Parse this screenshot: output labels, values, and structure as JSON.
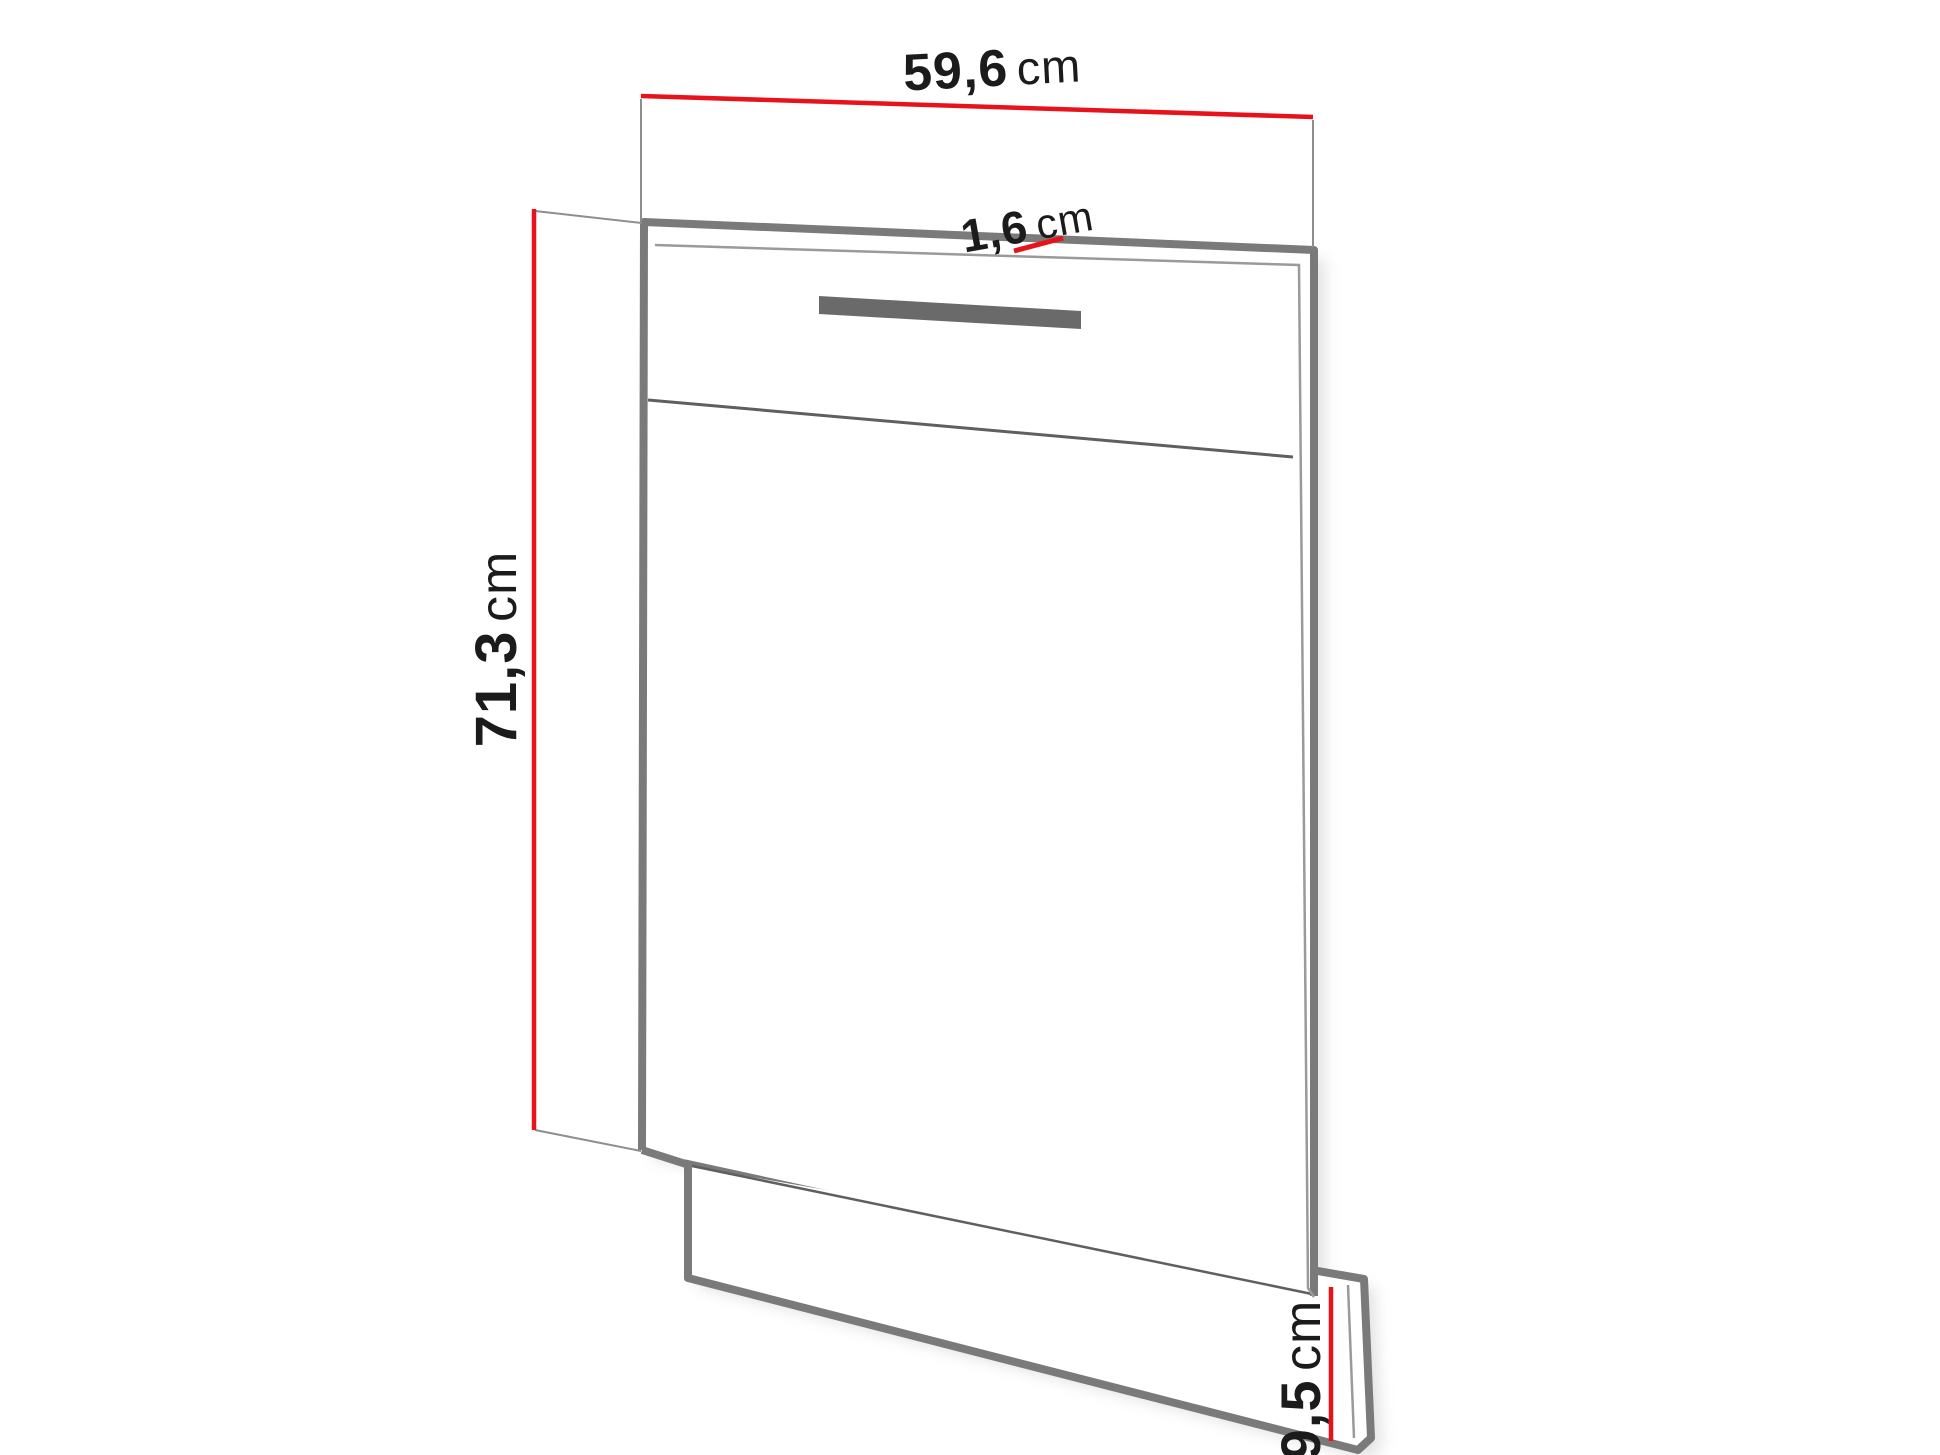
{
  "diagram": {
    "kind": "panel-dimension-drawing"
  },
  "dimensions": {
    "width": {
      "value": "59,6",
      "unit": "cm"
    },
    "thickness": {
      "value": "1,6",
      "unit": "cm"
    },
    "height": {
      "value": "71,3",
      "unit": "cm"
    },
    "plinth_height": {
      "value": "9,5",
      "unit": "cm"
    }
  },
  "colors": {
    "background": "#ffffff",
    "accent_red": "#e8121a",
    "outline_gray": "#7a7a7a",
    "inner_line_gray": "#9a9a9a",
    "thin_edge_gray": "#5f5f5f",
    "extension_gray": "#8e8e8e",
    "handle_gray": "#6a6a6a",
    "shadow_gray": "#cccccc",
    "panel_face": "#ffffff",
    "text_black": "#1b1b1b"
  }
}
